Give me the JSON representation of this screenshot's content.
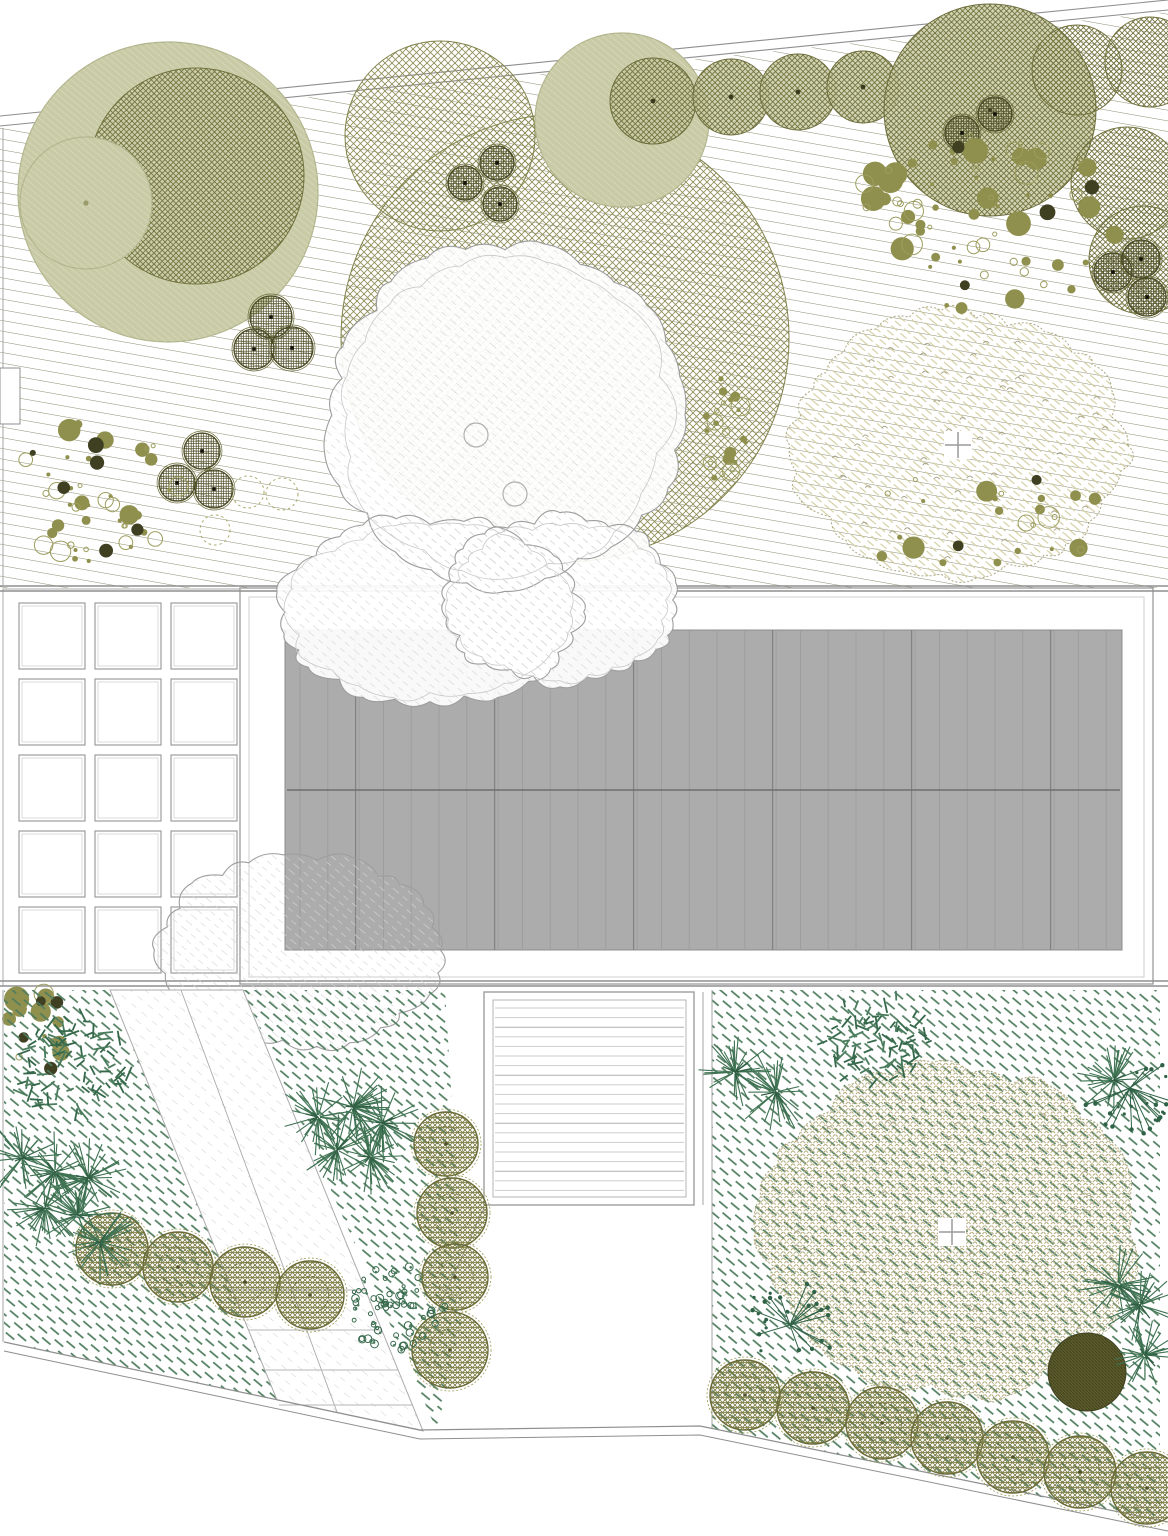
{
  "drawing": {
    "kind": "landscape-garden-plan",
    "canvas": {
      "w": 1168,
      "h": 1536
    },
    "palette": {
      "hatch": "#8d8d70",
      "crosshatch": "#73733f",
      "crosshatch_light": "#8f8f5c",
      "basket": "#50502a",
      "basket_edge": "#4a4a26",
      "sage_fill": "#c9cba6",
      "sage_edge": "#b2b58c",
      "scatter_fill": "#90904e",
      "scatter_dark": "#3f3f22",
      "scatter_ring": "#9d9d5e",
      "cloud_edge": "#9e9e9e",
      "cloud_hatch": "#d5d5d5",
      "beige": "#d2cda0",
      "beige_x": "#b5ae80",
      "beige_edge": "#aca784",
      "green_dash": "#4e7c5e",
      "spiky": "#3e7252",
      "fern": "#35684a",
      "fern2": "#4a7d5d",
      "berry": "#2f6246",
      "shrub": "#7c7c44",
      "shrub_edge": "#6b6b38",
      "shrub_ring": "#9a9a55",
      "dark_fill": "#5e5e2d",
      "dark_line": "#42421f",
      "roof_fill": "#acacac",
      "roof_line": "#9b9b9b",
      "roof_line_dark": "#828282",
      "ridge": "#6f6f6f",
      "gray_line": "#8f8f8f",
      "light_line": "#c6c6c6",
      "deck_slat": "#cdcdcd",
      "deck_slat_dark": "#b0b0b0",
      "grid_line": "#a5a5a5",
      "grid_line_inner": "#d2d2d2",
      "path_hatch": "#cfcfcf"
    },
    "meadow": {
      "poly": "0,128 1168,12 1168,588 0,588"
    },
    "fence_lines": [
      [
        0,
        116,
        1168,
        0
      ],
      [
        0,
        126,
        1168,
        10
      ]
    ],
    "mid_lines": [
      [
        0,
        586,
        1168,
        586
      ],
      [
        0,
        591,
        1168,
        591
      ]
    ],
    "low_lines": [
      [
        0,
        981,
        1168,
        981
      ],
      [
        0,
        986,
        1168,
        986
      ]
    ],
    "edge_segments": [
      [
        3,
        128,
        3,
        368
      ],
      [
        3,
        424,
        3,
        586
      ],
      [
        3,
        990,
        3,
        1342
      ],
      [
        712,
        990,
        712,
        1428
      ],
      [
        703,
        992,
        703,
        1205
      ],
      [
        437,
        1312,
        484,
        1208
      ]
    ],
    "notch": {
      "x": 0,
      "y": 368,
      "w": 20,
      "h": 56
    },
    "top_trees": [
      {
        "t": "sage",
        "x": 168,
        "y": 192,
        "r": 150
      },
      {
        "t": "cross",
        "x": 196,
        "y": 176,
        "r": 108
      },
      {
        "t": "sage",
        "x": 86,
        "y": 203,
        "r": 66,
        "dot": 1
      },
      {
        "t": "crossL",
        "x": 565,
        "y": 338,
        "r": 224
      },
      {
        "t": "crossL",
        "x": 440,
        "y": 136,
        "r": 95
      },
      {
        "t": "sage",
        "x": 622,
        "y": 120,
        "r": 87,
        "dot": 1
      },
      {
        "t": "chain",
        "x": 653,
        "y": 101,
        "r": 43
      },
      {
        "t": "chain",
        "x": 731,
        "y": 97,
        "r": 38
      },
      {
        "t": "chain",
        "x": 798,
        "y": 92,
        "r": 38
      },
      {
        "t": "chain",
        "x": 863,
        "y": 87,
        "r": 36
      },
      {
        "t": "chain",
        "x": 990,
        "y": 110,
        "r": 106
      },
      {
        "t": "cross",
        "x": 1077,
        "y": 70,
        "r": 45
      },
      {
        "t": "cross",
        "x": 1150,
        "y": 62,
        "r": 45
      },
      {
        "t": "cross",
        "x": 1127,
        "y": 183,
        "r": 56
      },
      {
        "t": "cross",
        "x": 1143,
        "y": 260,
        "r": 54
      }
    ],
    "baskets": [
      [
        465,
        183,
        17
      ],
      [
        497,
        163,
        17
      ],
      [
        500,
        204,
        17
      ],
      [
        271,
        317,
        21
      ],
      [
        254,
        349,
        20
      ],
      [
        292,
        348,
        21
      ],
      [
        202,
        451,
        18
      ],
      [
        177,
        483,
        18
      ],
      [
        214,
        489,
        19
      ],
      [
        1113,
        272,
        19
      ],
      [
        1141,
        259,
        19
      ],
      [
        1147,
        297,
        19
      ],
      [
        962,
        133,
        17
      ],
      [
        995,
        114,
        17
      ]
    ],
    "scatters": [
      {
        "cx": 985,
        "cy": 222,
        "rx": 135,
        "ry": 88,
        "nf": 42,
        "nr": 26,
        "nd": 4,
        "seed": 7,
        "rmin": 2,
        "rmax": 13
      },
      {
        "cx": 95,
        "cy": 492,
        "rx": 85,
        "ry": 72,
        "nf": 26,
        "nr": 18,
        "nd": 6,
        "seed": 13,
        "rmin": 2,
        "rmax": 12
      },
      {
        "cx": 985,
        "cy": 522,
        "rx": 140,
        "ry": 55,
        "nf": 16,
        "nr": 8,
        "nd": 2,
        "seed": 21,
        "rmin": 2,
        "rmax": 14
      },
      {
        "cx": 30,
        "cy": 1032,
        "rx": 36,
        "ry": 46,
        "nf": 12,
        "nr": 3,
        "nd": 4,
        "seed": 31,
        "rmin": 2,
        "rmax": 13
      },
      {
        "cx": 726,
        "cy": 430,
        "rx": 22,
        "ry": 58,
        "nf": 14,
        "nr": 10,
        "nd": 0,
        "seed": 41,
        "rmin": 2,
        "rmax": 11
      }
    ],
    "dotted_circles": [
      [
        215,
        530,
        15
      ],
      [
        248,
        492,
        16
      ],
      [
        282,
        494,
        16
      ],
      [
        248,
        1064,
        14
      ]
    ],
    "trunk_circles": [
      [
        476,
        435,
        12
      ],
      [
        515,
        494,
        12
      ]
    ],
    "clouds_main": [
      {
        "cx": 505,
        "cy": 415,
        "rx": 175,
        "ry": 168,
        "seed": 3
      },
      {
        "cx": 430,
        "cy": 612,
        "rx": 150,
        "ry": 92,
        "seed": 5
      },
      {
        "cx": 560,
        "cy": 600,
        "rx": 118,
        "ry": 82,
        "seed": 8
      }
    ],
    "cloud_lower": {
      "cx": 300,
      "cy": 950,
      "rx": 140,
      "ry": 95,
      "seed": 11
    },
    "beige_tree_top": {
      "cx": 958,
      "cy": 445,
      "rx": 166,
      "ry": 130,
      "seed": 17,
      "marks": 55
    },
    "beige_tree_bottom": {
      "cx": 952,
      "cy": 1232,
      "rx": 186,
      "ry": 162,
      "seed": 23,
      "marks": 70
    },
    "grid": {
      "outer": [
        3,
        589,
        237,
        397
      ],
      "x0": 19,
      "y0": 603,
      "tw": 66,
      "th": 66,
      "gx": 10,
      "gy": 10,
      "cols": 3,
      "rows": 5
    },
    "building": {
      "outer": [
        240,
        588,
        913,
        396
      ],
      "inner": [
        249,
        597,
        895,
        380
      ],
      "roof": [
        285,
        630,
        837,
        320
      ],
      "ridge_y": 790,
      "panels": 30,
      "panel_x0": 300,
      "panel_dx": 27.8
    },
    "deck": {
      "outer": [
        484,
        992,
        210,
        213
      ],
      "inner": [
        493,
        1000,
        193,
        197
      ],
      "slats": 20,
      "slat_y0": 1008,
      "slat_dy": 9.6
    },
    "beds": {
      "left": "4,990 110,990 277,1400 4,1342",
      "mid": "243,990 445,990 458,1205 462,1320 437,1431",
      "right": "712,990 1160,990 1160,1522 712,1428"
    },
    "path": {
      "poly": "110,990 243,990 423,1431 277,1400",
      "inner_line": [
        181,
        990,
        337,
        1412
      ],
      "steps": [
        [
          232,
          1290,
          365,
          1290
        ],
        [
          248,
          1330,
          381,
          1330
        ],
        [
          265,
          1370,
          398,
          1370
        ],
        [
          279,
          1405,
          412,
          1405
        ]
      ]
    },
    "boundary": {
      "pts": [
        [
          4,
          1342
        ],
        [
          420,
          1430
        ],
        [
          700,
          1426
        ],
        [
          1168,
          1522
        ]
      ],
      "offset": 9
    },
    "shrub_circles": [
      [
        112,
        1249,
        36
      ],
      [
        178,
        1267,
        35
      ],
      [
        245,
        1282,
        35
      ],
      [
        310,
        1295,
        34
      ],
      [
        446,
        1144,
        32
      ],
      [
        452,
        1213,
        35
      ],
      [
        455,
        1277,
        33
      ],
      [
        450,
        1350,
        38
      ],
      [
        745,
        1395,
        35
      ],
      [
        813,
        1408,
        36
      ],
      [
        882,
        1423,
        36
      ],
      [
        947,
        1438,
        36
      ],
      [
        1013,
        1457,
        36
      ],
      [
        1080,
        1472,
        36
      ],
      [
        1147,
        1488,
        36
      ]
    ],
    "dark_shrub": {
      "x": 1087,
      "y": 1372,
      "r": 39
    },
    "spiky_grasses": [
      [
        22,
        1158,
        40
      ],
      [
        55,
        1172,
        42
      ],
      [
        88,
        1178,
        40
      ],
      [
        45,
        1208,
        40
      ],
      [
        78,
        1215,
        38
      ],
      [
        100,
        1242,
        38
      ],
      [
        318,
        1117,
        40
      ],
      [
        353,
        1107,
        42
      ],
      [
        382,
        1123,
        40
      ],
      [
        337,
        1150,
        40
      ],
      [
        370,
        1157,
        38
      ],
      [
        735,
        1072,
        40
      ],
      [
        776,
        1092,
        42
      ],
      [
        1114,
        1080,
        38
      ],
      [
        1118,
        1285,
        40
      ],
      [
        1140,
        1305,
        38
      ],
      [
        1145,
        1355,
        36
      ]
    ],
    "ferns": [
      [
        73,
        1068,
        58
      ],
      [
        878,
        1040,
        52
      ]
    ],
    "leafy_bushes": [
      [
        395,
        1308,
        50
      ]
    ],
    "berry_plants": [
      [
        790,
        1325,
        46
      ],
      [
        1130,
        1088,
        50
      ]
    ]
  }
}
